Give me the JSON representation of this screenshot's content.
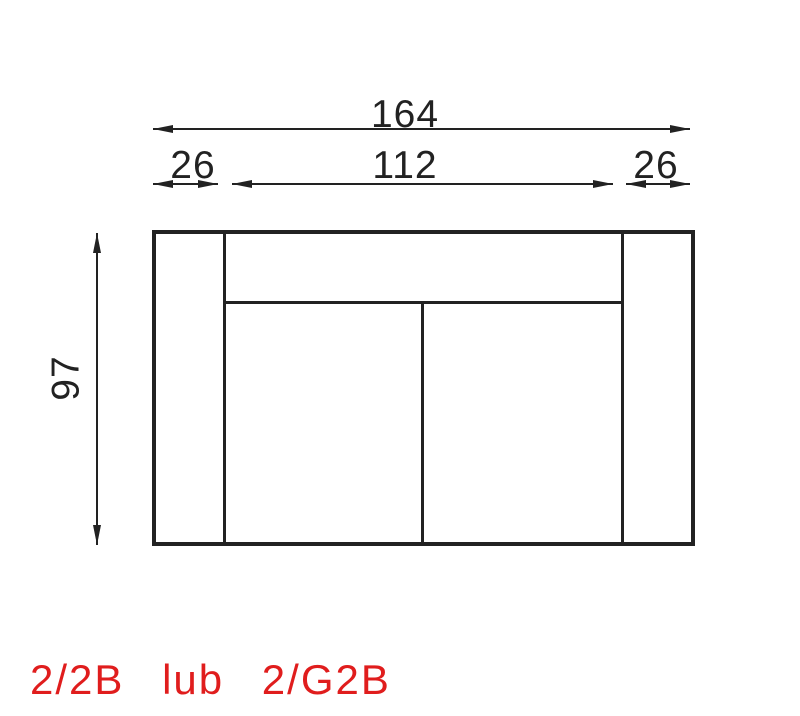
{
  "diagram": {
    "type": "furniture-dimension-drawing",
    "view": "top-view-sofa",
    "dimensions": {
      "total_width": "164",
      "left_armrest_width": "26",
      "seat_width": "112",
      "right_armrest_width": "26",
      "depth": "97"
    },
    "caption": {
      "text": "2/2B lub 2/G2B"
    },
    "colors": {
      "line": "#222222",
      "caption": "#e01d1d",
      "background": "#ffffff"
    }
  }
}
